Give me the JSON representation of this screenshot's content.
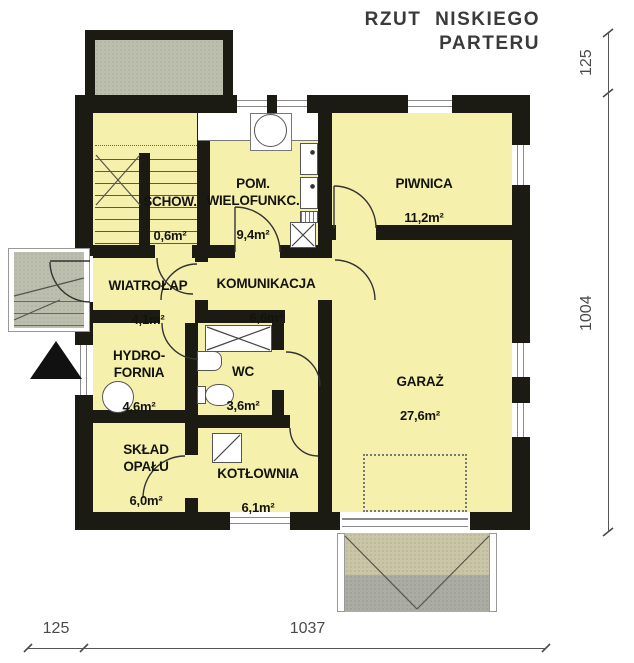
{
  "title": {
    "line1": "RZUT NISKIEGO",
    "line2": "PARTERU"
  },
  "rooms": [
    {
      "id": "schowek",
      "name": "SCHOW.",
      "area": "0,6m²"
    },
    {
      "id": "pom-wielofunkcyjne",
      "name": "POM. WIELOFUNKC.",
      "area": "9,4m²"
    },
    {
      "id": "piwnica",
      "name": "PIWNICA",
      "area": "11,2m²"
    },
    {
      "id": "wiatrolap",
      "name": "WIATROŁAP",
      "area": "4,1m²"
    },
    {
      "id": "komunikacja",
      "name": "KOMUNIKACJA",
      "area": "6,6m²"
    },
    {
      "id": "hydrofornia",
      "name": "HYDRO-FORNIA",
      "area": "4,6m²"
    },
    {
      "id": "wc",
      "name": "WC",
      "area": "3,6m²"
    },
    {
      "id": "garaz",
      "name": "GARAŻ",
      "area": "27,6m²"
    },
    {
      "id": "sklad-opalu",
      "name": "SKŁAD OPAŁU",
      "area": "6,0m²"
    },
    {
      "id": "kotlownia",
      "name": "KOTŁOWNIA",
      "area": "6,1m²"
    }
  ],
  "dimensions": {
    "top_right": "125",
    "right_side": "1004",
    "bottom_left": "125",
    "bottom_main": "1037"
  },
  "colors": {
    "wall": "#1b1b14",
    "room_fill": "#f5f1ad",
    "terrace_gray": "#bcbeae",
    "driveway_upper": "#c9c5a6",
    "driveway_lower": "#abaca3",
    "dimension_text": "#4a4a4a",
    "title_text": "#3a3a3a"
  }
}
